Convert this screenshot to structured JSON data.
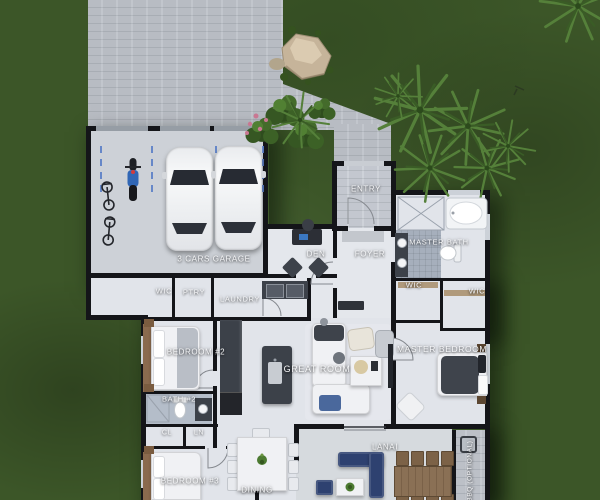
{
  "meta": {
    "scene": "3D rendered residential floor plan, top-down site view",
    "canvas": {
      "width": 600,
      "height": 500
    }
  },
  "palette": {
    "grass": "#3c5628",
    "pavement": "#bcc0c7",
    "floor": "#e1e4ea",
    "tile": "#a6afbc",
    "wall": "#141519",
    "counter": "#3c4149",
    "wood": "#8a6a4e",
    "lanai_navy": "#2e4170",
    "parking_line_blue": "#5b7fc7",
    "label_text": "#f5f6f8"
  },
  "rooms": [
    {
      "id": "garage",
      "label": "3 CARS GARAGE",
      "x": 214,
      "y": 259,
      "size": 8
    },
    {
      "id": "wic-hall",
      "label": "WIC",
      "x": 164,
      "y": 291,
      "size": 7.5
    },
    {
      "id": "pantry",
      "label": "PTRY",
      "x": 194,
      "y": 292,
      "size": 7.5
    },
    {
      "id": "laundry",
      "label": "LAUNDRY",
      "x": 240,
      "y": 299,
      "size": 7.5
    },
    {
      "id": "entry",
      "label": "ENTRY",
      "x": 366,
      "y": 189,
      "size": 8
    },
    {
      "id": "foyer",
      "label": "FOYER",
      "x": 370,
      "y": 254,
      "size": 8
    },
    {
      "id": "den",
      "label": "DEN",
      "x": 316,
      "y": 254,
      "size": 8
    },
    {
      "id": "master-bath",
      "label": "MASTER BATH",
      "x": 439,
      "y": 242,
      "size": 7.5
    },
    {
      "id": "wic-master-1",
      "label": "WIC",
      "x": 414,
      "y": 285,
      "size": 7.5
    },
    {
      "id": "wic-master-2",
      "label": "WIC",
      "x": 477,
      "y": 291,
      "size": 7.5
    },
    {
      "id": "bedroom-2",
      "label": "BEDROOM #2",
      "x": 196,
      "y": 352,
      "size": 8
    },
    {
      "id": "great-room",
      "label": "GREAT ROOM",
      "x": 317,
      "y": 369,
      "size": 9
    },
    {
      "id": "master-bedroom",
      "label": "MASTER BEDROOM",
      "x": 442,
      "y": 349,
      "size": 8.5
    },
    {
      "id": "bath-2",
      "label": "BATH #2",
      "x": 179,
      "y": 399,
      "size": 7.5
    },
    {
      "id": "closet",
      "label": "CL",
      "x": 167,
      "y": 433,
      "size": 7
    },
    {
      "id": "linen",
      "label": "LN",
      "x": 199,
      "y": 433,
      "size": 7
    },
    {
      "id": "bedroom-3",
      "label": "BEDROOM #3",
      "x": 190,
      "y": 481,
      "size": 8
    },
    {
      "id": "dining",
      "label": "DINING",
      "x": 257,
      "y": 490,
      "size": 8
    },
    {
      "id": "lanai",
      "label": "LANAI",
      "x": 385,
      "y": 447,
      "size": 8
    },
    {
      "id": "bbq",
      "label": "BBQ (OPTIONAL)",
      "x": 470,
      "y": 471,
      "size": 6.5,
      "vertical": true
    }
  ],
  "objects": [
    "two white cars in garage",
    "blue motorcycle",
    "two bicycles",
    "dashed blue parking-space lines",
    "paver driveway and entry walkway",
    "boulder with shrubs",
    "palm plants",
    "entry shrubs with pink flowers",
    "kitchen island with sink",
    "kitchen counter with double oven",
    "washer and dryer in laundry",
    "dining table with eight chairs and plant",
    "great room sectional sofa with throws",
    "coffee table with tray",
    "armchair and recliner",
    "den desk with laptop and two accent chairs",
    "foyer console",
    "beds in bedroom 2, bedroom 3 and master bedroom",
    "bathtub",
    "walk-in showers",
    "toilets and vanities",
    "lanai navy sectional, ottoman and coffee table",
    "outdoor dining table with eight chairs",
    "bbq grill marker",
    "door swing arcs"
  ]
}
